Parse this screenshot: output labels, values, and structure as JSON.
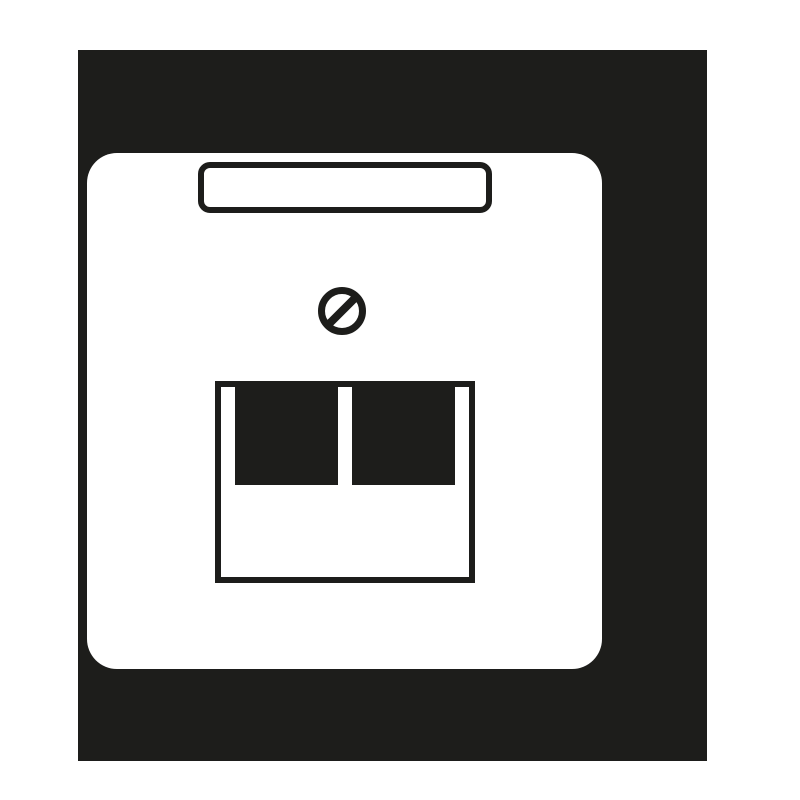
{
  "canvas": {
    "background": "#ffffff"
  },
  "colors": {
    "ink": "#1d1d1b",
    "plate": "#ffffff",
    "bg": "#ffffff"
  },
  "icon": {
    "name": "network-wall-outlet-pictogram",
    "style": "flat monochrome pictogram",
    "parts": [
      {
        "name": "backdrop-square",
        "fill": "#1d1d1b"
      },
      {
        "name": "faceplate",
        "fill": "#ffffff"
      },
      {
        "name": "label-window",
        "stroke": "#1d1d1b"
      },
      {
        "name": "screw-head-icon",
        "stroke": "#1d1d1b"
      },
      {
        "name": "socket-frame",
        "stroke": "#1d1d1b"
      },
      {
        "name": "port-opening-left",
        "fill": "#1d1d1b"
      },
      {
        "name": "port-opening-right",
        "fill": "#1d1d1b"
      }
    ],
    "port_count": 2
  }
}
